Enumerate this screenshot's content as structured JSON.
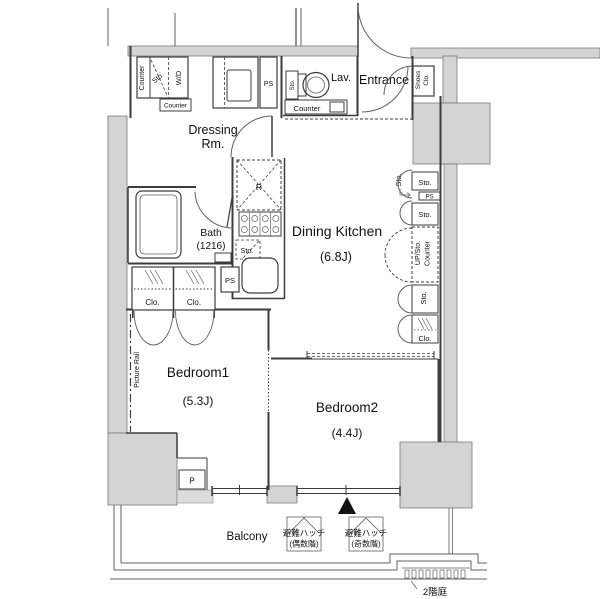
{
  "labels": {
    "dressing_1": "Dressing",
    "dressing_2": "Rm.",
    "lav": "Lav.",
    "entrance": "Entrance",
    "shoes_1": "Shoes",
    "shoes_2": "Clo.",
    "dining_kitchen": "Dining Kitchen",
    "dk_size": "(6.8J)",
    "bath": "Bath",
    "bath_size": "(1216)",
    "bedroom1": "Bedroom1",
    "bedroom1_size": "(5.3J)",
    "bedroom2": "Bedroom2",
    "bedroom2_size": "(4.4J)",
    "balcony": "Balcony",
    "counter": "Counter",
    "sto": "Sto.",
    "wd": "W/D",
    "ps": "PS",
    "clo": "Clo.",
    "r": "R",
    "up_sto": "UP/Sto.",
    "picture_rail": "Picture Rail",
    "p": "P",
    "hatch": "避難ハッチ",
    "hatch_even": "(偶数階)",
    "hatch_odd": "(奇数階)",
    "garden_2f": "2階庭"
  },
  "colors": {
    "wall_fill": "#d4d4d4",
    "line": "#3c3c3c",
    "text": "#111111",
    "background": "#ffffff"
  }
}
